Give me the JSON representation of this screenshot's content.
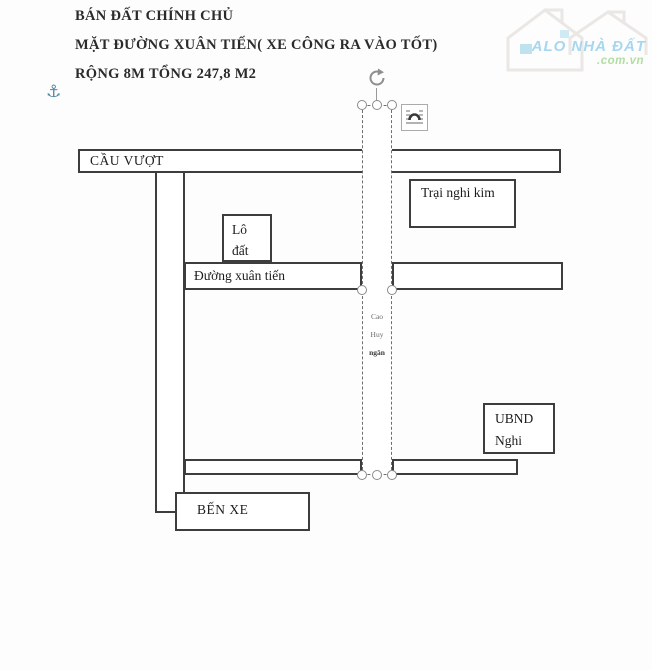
{
  "listing": {
    "line1": "BÁN ĐẤT CHÍNH CHỦ",
    "line2": "MẶT ĐƯỜNG XUÂN TIẾN( XE CÔNG RA VÀO TỐT)",
    "line3": "RỘNG 8M TỔNG 247,8 M2"
  },
  "watermark": {
    "brand": "ALO NHÀ ĐẤT",
    "domain": ".com.vn",
    "brand_color": "#a7d7ee",
    "domain_color": "#b2dda2"
  },
  "icons": {
    "anchor": "⚓"
  },
  "diagram": {
    "line_color": "#3d3d3d",
    "selection_color": "#6e6e6e",
    "labels": {
      "overpass": "CẦU VƯỢT",
      "camp": "Trại nghi kim",
      "plot_line1": "Lô",
      "plot_line2": "đất",
      "road": "Đường xuân tiến",
      "owner_line1": "Cao",
      "owner_line2": "Huy",
      "owner_line3": "ngân",
      "committee_line1": "UBND",
      "committee_line2": "Nghi",
      "bus_station": "BẾN XE"
    }
  }
}
